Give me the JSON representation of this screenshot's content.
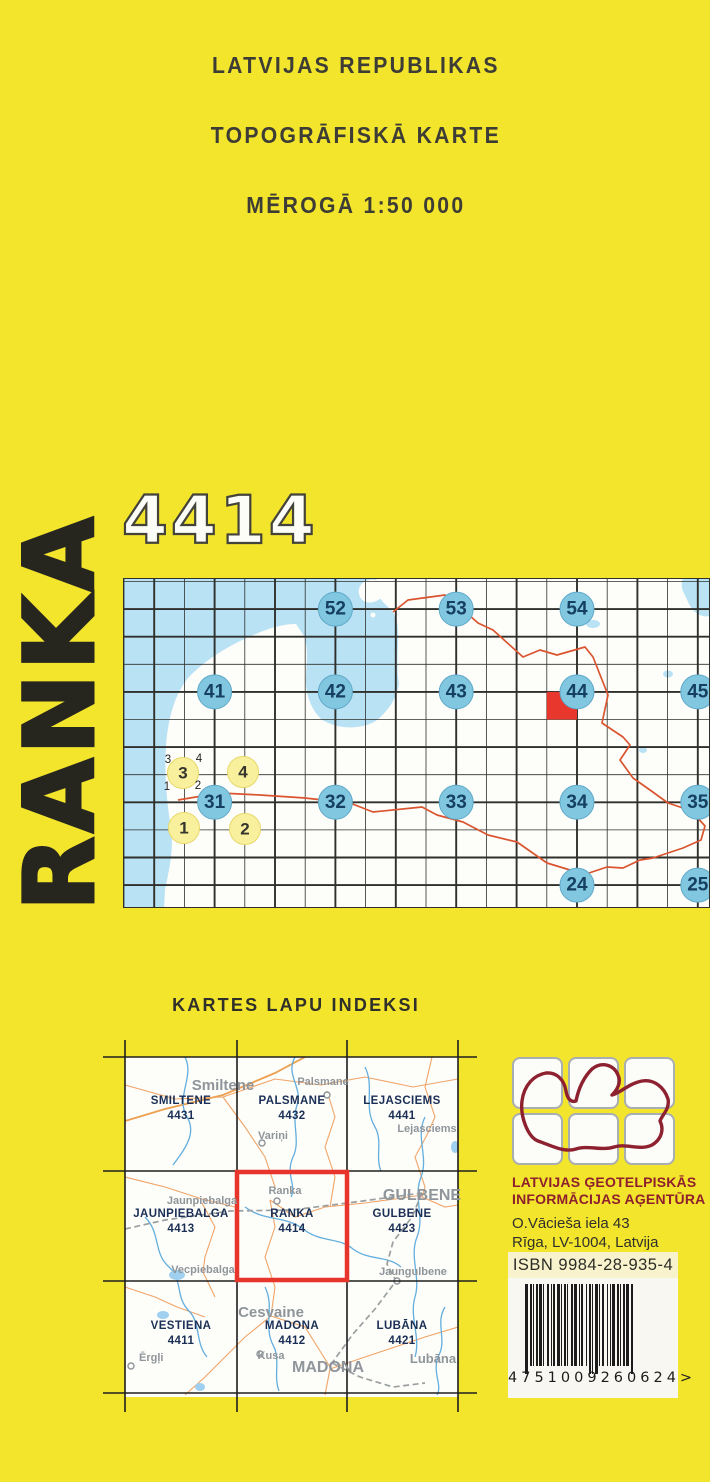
{
  "header": {
    "line1": "LATVIJAS REPUBLIKAS",
    "line2": "TOPOGRĀFISKĀ KARTE",
    "line3": "MĒROGĀ 1:50 000"
  },
  "sheet": {
    "number": "4414",
    "name": "RANKA"
  },
  "overview_map": {
    "sheet_circles": [
      {
        "label": "52",
        "x": 212.4,
        "y": 31.1
      },
      {
        "label": "53",
        "x": 333.2,
        "y": 31.1
      },
      {
        "label": "54",
        "x": 454,
        "y": 31.1
      },
      {
        "label": "41",
        "x": 91.6,
        "y": 113.9
      },
      {
        "label": "42",
        "x": 212.4,
        "y": 113.9
      },
      {
        "label": "43",
        "x": 333.2,
        "y": 113.9
      },
      {
        "label": "44",
        "x": 454,
        "y": 113.9
      },
      {
        "label": "45",
        "x": 574.8,
        "y": 113.9
      },
      {
        "label": "31",
        "x": 91.6,
        "y": 224.3
      },
      {
        "label": "32",
        "x": 212.4,
        "y": 224.3
      },
      {
        "label": "33",
        "x": 333.2,
        "y": 224.3
      },
      {
        "label": "34",
        "x": 454,
        "y": 224.3
      },
      {
        "label": "35",
        "x": 574.8,
        "y": 224.3
      },
      {
        "label": "24",
        "x": 454,
        "y": 307.1
      },
      {
        "label": "25",
        "x": 574.8,
        "y": 307.1
      }
    ],
    "quarter_circles": [
      {
        "label": "3",
        "x": 60,
        "y": 195
      },
      {
        "label": "4",
        "x": 120,
        "y": 194
      },
      {
        "label": "1",
        "x": 61,
        "y": 250
      },
      {
        "label": "2",
        "x": 122,
        "y": 251
      }
    ],
    "quarter_digits": [
      {
        "label": "3",
        "x": 45,
        "y": 182
      },
      {
        "label": "4",
        "x": 76,
        "y": 181
      },
      {
        "label": "1",
        "x": 44,
        "y": 209
      },
      {
        "label": "2",
        "x": 75,
        "y": 208
      }
    ]
  },
  "index_map": {
    "heading": "KARTES LAPU INDEKSI",
    "sheets": [
      {
        "name": "SMILTENE",
        "number": "4431",
        "cx": 56,
        "cy": 47
      },
      {
        "name": "PALSMANE",
        "number": "4432",
        "cx": 167,
        "cy": 47
      },
      {
        "name": "LEJASCIEMS",
        "number": "4441",
        "cx": 277,
        "cy": 47
      },
      {
        "name": "JAUNPIEBALGA",
        "number": "4413",
        "cx": 56,
        "cy": 160
      },
      {
        "name": "RANKA",
        "number": "4414",
        "cx": 167,
        "cy": 160
      },
      {
        "name": "GULBENE",
        "number": "4423",
        "cx": 277,
        "cy": 160
      },
      {
        "name": "VESTIENA",
        "number": "4411",
        "cx": 56,
        "cy": 272
      },
      {
        "name": "MADONA",
        "number": "4412",
        "cx": 167,
        "cy": 272
      },
      {
        "name": "LUBĀNA",
        "number": "4421",
        "cx": 277,
        "cy": 272
      }
    ],
    "places": [
      {
        "text": "Smiltene",
        "x": 98,
        "y": 33,
        "size": 15,
        "bold": true
      },
      {
        "text": "Palsmane",
        "x": 198,
        "y": 28,
        "size": 11,
        "bold": true
      },
      {
        "text": "Variņi",
        "x": 148,
        "y": 82,
        "size": 11,
        "bold": true
      },
      {
        "text": "Lejasciems",
        "x": 302,
        "y": 75,
        "size": 11,
        "bold": true
      },
      {
        "text": "Jaunpiebalga",
        "x": 77,
        "y": 147,
        "size": 11,
        "bold": true
      },
      {
        "text": "Ranka",
        "x": 160,
        "y": 137,
        "size": 11,
        "bold": true
      },
      {
        "text": "GULBENE",
        "x": 297,
        "y": 143,
        "size": 16,
        "bold": true
      },
      {
        "text": "Vecpiebalga",
        "x": 78,
        "y": 216,
        "size": 11,
        "bold": true
      },
      {
        "text": "Jaungulbene",
        "x": 288,
        "y": 218,
        "size": 11,
        "bold": true
      },
      {
        "text": "Cesvaine",
        "x": 146,
        "y": 260,
        "size": 15,
        "bold": true
      },
      {
        "text": "Kusa",
        "x": 146,
        "y": 302,
        "size": 11,
        "bold": true
      },
      {
        "text": "MADONA",
        "x": 203,
        "y": 315,
        "size": 16,
        "bold": true
      },
      {
        "text": "Ērgļi",
        "x": 14,
        "y": 304,
        "size": 11,
        "bold": true,
        "anchor": "start"
      },
      {
        "text": "Lubāna",
        "x": 308,
        "y": 306,
        "size": 13,
        "bold": true
      }
    ]
  },
  "publisher": {
    "name_line1": "LATVIJAS ĢEOTELPISKĀS",
    "name_line2": "INFORMĀCIJAS AĢENTŪRA",
    "address_line1": "O.Vācieša iela 43",
    "address_line2": "Rīga, LV-1004, Latvija",
    "isbn": "ISBN 9984-28-935-4",
    "barcode_display": "4751009260624>"
  },
  "colors": {
    "page_yellow": "#f3e42c",
    "sea_blue": "#b9e2f4",
    "land_white": "#fdfdf9",
    "circle_blue_fill": "#82c7e0",
    "circle_blue_stroke": "#5fa9c9",
    "circle_blue_text": "#16405f",
    "circle_yellow_fill": "#f8f09c",
    "circle_yellow_stroke": "#e8d96a",
    "circle_yellow_text": "#35352e",
    "highlight_red": "#e8372c",
    "country_border_orange": "#d9542f",
    "sheet_label_navy": "#1b2f56",
    "place_label_gray": "#8f959a",
    "road_orange": "#f0a468",
    "river_blue": "#63aede",
    "railway_gray": "#9aa0a2",
    "agency_red": "#8e1f2d"
  }
}
